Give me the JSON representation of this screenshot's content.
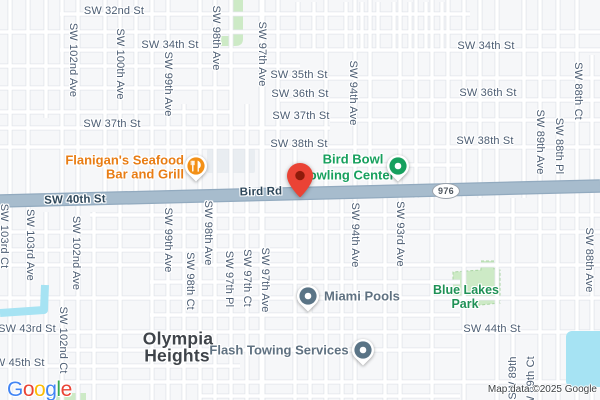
{
  "map": {
    "attribution": "Map data ©2025 Google",
    "logo": {
      "text": "Google",
      "letter_colors": [
        "#4285F4",
        "#EA4335",
        "#FBBC05",
        "#4285F4",
        "#34A853",
        "#EA4335"
      ]
    },
    "route_shield": {
      "text": "976",
      "x": 445,
      "y": 190
    },
    "destination_pin": {
      "x": 300,
      "y": 197
    },
    "colors": {
      "bg": "#f6f7f9",
      "road_fill": "#ffffff",
      "road_casing": "#e1e5ea",
      "major_fill": "#a7bccd",
      "major_casing": "#92aabf",
      "water": "#a6e3f3",
      "park": "#cdeac6",
      "park_edge": "#a9d4a2",
      "lot": "#e9edf1",
      "street_label": "#4c5d73",
      "onroad_label": "#2e475a",
      "poi_gray": "#5f7181",
      "poi_orange": "#e87d15",
      "icon_orange": "#f39016",
      "poi_green": "#17a05e",
      "icon_gray": "#5a7486",
      "park_label": "#1f9156",
      "neighborhood": "#3f444a",
      "pin": "#ea4335",
      "pin_inner": "#8e1b0b",
      "shield_border": "#9aa2ab",
      "shield_text": "#4e565e",
      "attribution": "#3c4043"
    },
    "street_labels": [
      {
        "t": "SW 32nd St",
        "x": 114,
        "y": 11
      },
      {
        "t": "SW 34th St",
        "x": 170,
        "y": 45
      },
      {
        "t": "SW 34th St",
        "x": 486,
        "y": 46
      },
      {
        "t": "SW 35th St",
        "x": 299,
        "y": 75
      },
      {
        "t": "SW 36th St",
        "x": 300,
        "y": 94
      },
      {
        "t": "SW 36th St",
        "x": 488,
        "y": 93
      },
      {
        "t": "SW 37th St",
        "x": 112,
        "y": 124
      },
      {
        "t": "SW 37th St",
        "x": 301,
        "y": 116
      },
      {
        "t": "SW 38th St",
        "x": 299,
        "y": 144
      },
      {
        "t": "SW 38th St",
        "x": 485,
        "y": 141
      },
      {
        "t": "SW 43rd St",
        "x": 27,
        "y": 329
      },
      {
        "t": "SW 44th St",
        "x": 492,
        "y": 329
      },
      {
        "t": "SW 45th St",
        "x": 16,
        "y": 363
      },
      {
        "t": "SW 40th St",
        "x": 75,
        "y": 200,
        "cls": "onroad",
        "name": "road-label-sw-40th-st"
      },
      {
        "t": "Bird Rd",
        "x": 261,
        "y": 192,
        "cls": "onroad",
        "name": "road-label-bird-rd"
      },
      {
        "t": "SW 102nd Ave",
        "x": 73,
        "y": 60,
        "cls": "v"
      },
      {
        "t": "SW 100th Ave",
        "x": 120,
        "y": 64,
        "cls": "v"
      },
      {
        "t": "SW 99th Ave",
        "x": 168,
        "y": 84,
        "cls": "v"
      },
      {
        "t": "SW 98th Ave",
        "x": 216,
        "y": 38,
        "cls": "v"
      },
      {
        "t": "SW 97th Ave",
        "x": 262,
        "y": 54,
        "cls": "v"
      },
      {
        "t": "SW 94th Ave",
        "x": 353,
        "y": 93,
        "cls": "v"
      },
      {
        "t": "SW 89th Ave",
        "x": 540,
        "y": 142,
        "cls": "v"
      },
      {
        "t": "SW 88th Pl",
        "x": 559,
        "y": 146,
        "cls": "v"
      },
      {
        "t": "SW 88th Ct",
        "x": 578,
        "y": 91,
        "cls": "v"
      },
      {
        "t": "SW 103rd Ct",
        "x": 4,
        "y": 236,
        "cls": "v"
      },
      {
        "t": "SW 103rd Ave",
        "x": 30,
        "y": 245,
        "cls": "v"
      },
      {
        "t": "SW 102nd Ave",
        "x": 76,
        "y": 253,
        "cls": "v"
      },
      {
        "t": "SW 99th Ave",
        "x": 168,
        "y": 240,
        "cls": "v"
      },
      {
        "t": "SW 98th Ave",
        "x": 208,
        "y": 233,
        "cls": "v"
      },
      {
        "t": "SW 98th Ct",
        "x": 190,
        "y": 281,
        "cls": "v"
      },
      {
        "t": "SW 97th Pl",
        "x": 229,
        "y": 279,
        "cls": "v"
      },
      {
        "t": "SW 97th Ct",
        "x": 247,
        "y": 278,
        "cls": "v"
      },
      {
        "t": "SW 97th Ave",
        "x": 265,
        "y": 280,
        "cls": "v"
      },
      {
        "t": "SW 94th Ave",
        "x": 355,
        "y": 235,
        "cls": "v"
      },
      {
        "t": "SW 93rd Ave",
        "x": 400,
        "y": 234,
        "cls": "v"
      },
      {
        "t": "SW 88th Ave",
        "x": 589,
        "y": 260,
        "cls": "v"
      },
      {
        "t": "SW 102nd Ct",
        "x": 63,
        "y": 340,
        "cls": "v"
      },
      {
        "t": "SW 89th",
        "x": 513,
        "y": 378,
        "cls": "vu"
      },
      {
        "t": "SW 89th Ct",
        "x": 531,
        "y": 385,
        "cls": "vu"
      }
    ],
    "pois": [
      {
        "id": "flanigans-seafood-bar-and-grill",
        "color": "#e87d15",
        "icon": {
          "type": "restaurant",
          "bg": "#f39016",
          "x": 196,
          "y": 166
        },
        "lines": [
          {
            "t": "Flanigan's Seafood",
            "x": 184,
            "y": 160,
            "anchor": "r"
          },
          {
            "t": "Bar and Grill",
            "x": 184,
            "y": 174,
            "anchor": "r"
          }
        ]
      },
      {
        "id": "bird-bowl-bowling-center",
        "color": "#17a05e",
        "icon": {
          "type": "dot",
          "bg": "#17a05e",
          "x": 398,
          "y": 166
        },
        "lines": [
          {
            "t": "Bird Bowl",
            "x": 353,
            "y": 159
          },
          {
            "t": "Bowling Center",
            "x": 347,
            "y": 175
          }
        ]
      },
      {
        "id": "miami-pools",
        "color": "#5f7181",
        "icon": {
          "type": "dot",
          "bg": "#5a7486",
          "x": 308,
          "y": 296
        },
        "lines": [
          {
            "t": "Miami Pools",
            "x": 324,
            "y": 296,
            "anchor": "l"
          }
        ]
      },
      {
        "id": "flash-towing-services",
        "color": "#5f7181",
        "icon": {
          "type": "dot",
          "bg": "#5a7486",
          "x": 363,
          "y": 350
        },
        "lines": [
          {
            "t": "Flash Towing Services",
            "x": 279,
            "y": 350
          }
        ]
      }
    ],
    "areas": [
      {
        "id": "olympia-heights",
        "cls": "neigh",
        "color": "#3f444a",
        "lines": [
          {
            "t": "Olympia",
            "x": 178,
            "y": 339
          },
          {
            "t": "Heights",
            "x": 177,
            "y": 356
          }
        ]
      },
      {
        "id": "blue-lakes-park",
        "cls": "park-lbl",
        "color": "#1f9156",
        "lines": [
          {
            "t": "Blue Lakes",
            "x": 466,
            "y": 290
          },
          {
            "t": "Park",
            "x": 465,
            "y": 304
          }
        ]
      }
    ],
    "geometry": {
      "major_road": {
        "x1": 0,
        "y1": 201,
        "x2": 600,
        "y2": 186
      },
      "vertical_roads": [
        {
          "x": 10,
          "y1": 0,
          "y2": 400
        },
        {
          "x": 28,
          "y1": 0,
          "y2": 400
        },
        {
          "x": 46,
          "y1": 0,
          "y2": 118
        },
        {
          "x": 46,
          "y1": 212,
          "y2": 400
        },
        {
          "x": 62,
          "y1": 0,
          "y2": 400
        },
        {
          "x": 78,
          "y1": 0,
          "y2": 400
        },
        {
          "x": 94,
          "y1": 212,
          "y2": 400
        },
        {
          "x": 105,
          "y1": 0,
          "y2": 197
        },
        {
          "x": 120,
          "y1": 0,
          "y2": 400
        },
        {
          "x": 136,
          "y1": 0,
          "y2": 197
        },
        {
          "x": 152,
          "y1": 0,
          "y2": 400
        },
        {
          "x": 168,
          "y1": 0,
          "y2": 400
        },
        {
          "x": 184,
          "y1": 104,
          "y2": 400
        },
        {
          "x": 200,
          "y1": 0,
          "y2": 400
        },
        {
          "x": 215,
          "y1": 0,
          "y2": 400
        },
        {
          "x": 231,
          "y1": 0,
          "y2": 400
        },
        {
          "x": 247,
          "y1": 104,
          "y2": 400
        },
        {
          "x": 262,
          "y1": 0,
          "y2": 400,
          "w": 1
        },
        {
          "x": 278,
          "y1": 0,
          "y2": 198
        },
        {
          "x": 295,
          "y1": 142,
          "y2": 400
        },
        {
          "x": 310,
          "y1": 198,
          "y2": 400
        },
        {
          "x": 326,
          "y1": 0,
          "y2": 400
        },
        {
          "x": 342,
          "y1": 198,
          "y2": 400
        },
        {
          "x": 355,
          "y1": 0,
          "y2": 400
        },
        {
          "x": 370,
          "y1": 0,
          "y2": 198
        },
        {
          "x": 385,
          "y1": 198,
          "y2": 400
        },
        {
          "x": 400,
          "y1": 0,
          "y2": 400
        },
        {
          "x": 416,
          "y1": 0,
          "y2": 198
        },
        {
          "x": 432,
          "y1": 0,
          "y2": 400
        },
        {
          "x": 448,
          "y1": 0,
          "y2": 198
        },
        {
          "x": 464,
          "y1": 0,
          "y2": 400
        },
        {
          "x": 480,
          "y1": 0,
          "y2": 198
        },
        {
          "x": 497,
          "y1": 0,
          "y2": 400
        },
        {
          "x": 513,
          "y1": 198,
          "y2": 400
        },
        {
          "x": 524,
          "y1": 0,
          "y2": 198
        },
        {
          "x": 540,
          "y1": 0,
          "y2": 400
        },
        {
          "x": 558,
          "y1": 0,
          "y2": 400
        },
        {
          "x": 577,
          "y1": 0,
          "y2": 400
        },
        {
          "x": 592,
          "y1": 55,
          "y2": 400
        },
        {
          "x": 298,
          "y1": 2,
          "y2": 50
        },
        {
          "x": 314,
          "y1": 2,
          "y2": 50
        },
        {
          "x": 346,
          "y1": 2,
          "y2": 50
        },
        {
          "x": 362,
          "y1": 2,
          "y2": 50
        },
        {
          "x": 378,
          "y1": 2,
          "y2": 50
        },
        {
          "x": 394,
          "y1": 2,
          "y2": 50
        },
        {
          "x": 410,
          "y1": 2,
          "y2": 50
        },
        {
          "x": 426,
          "y1": 2,
          "y2": 50
        },
        {
          "x": 442,
          "y1": 2,
          "y2": 50
        }
      ],
      "horizontal_roads": [
        {
          "y": 14,
          "x1": 60,
          "x2": 470
        },
        {
          "y": 32,
          "x1": 0,
          "x2": 600
        },
        {
          "y": 50,
          "x1": 60,
          "x2": 600
        },
        {
          "y": 66,
          "x1": 0,
          "x2": 300
        },
        {
          "y": 78,
          "x1": 280,
          "x2": 600
        },
        {
          "y": 88,
          "x1": 0,
          "x2": 230
        },
        {
          "y": 100,
          "x1": 280,
          "x2": 600
        },
        {
          "y": 112,
          "x1": 0,
          "x2": 230
        },
        {
          "y": 120,
          "x1": 330,
          "x2": 600
        },
        {
          "y": 128,
          "x1": 0,
          "x2": 330
        },
        {
          "y": 147,
          "x1": 0,
          "x2": 600
        },
        {
          "y": 165,
          "x1": 332,
          "x2": 462
        },
        {
          "y": 215,
          "x1": 90,
          "x2": 600
        },
        {
          "y": 232,
          "x1": 0,
          "x2": 600
        },
        {
          "y": 250,
          "x1": 0,
          "x2": 300
        },
        {
          "y": 265,
          "x1": 0,
          "x2": 600
        },
        {
          "y": 282,
          "x1": 150,
          "x2": 460
        },
        {
          "y": 298,
          "x1": 0,
          "x2": 600
        },
        {
          "y": 315,
          "x1": 150,
          "x2": 460
        },
        {
          "y": 332,
          "x1": 0,
          "x2": 600
        },
        {
          "y": 350,
          "x1": 60,
          "x2": 460
        },
        {
          "y": 366,
          "x1": 0,
          "x2": 240
        },
        {
          "y": 382,
          "x1": 60,
          "x2": 600
        },
        {
          "y": 396,
          "x1": 200,
          "x2": 460
        }
      ],
      "parks": [
        {
          "d": "M229 0 H243 V39 Q243 46 235 46 H221 V36 H229 Z"
        },
        {
          "d": "M481 261 L494 261 L494 269 L500 270 L500 303 L471 306 L453 302 L453 272 L481 270 Z",
          "dashed": true
        },
        {
          "d": "M46 393 H86 V400 H46 Z"
        }
      ],
      "water": [
        {
          "type": "rect",
          "x": 566,
          "y": 331,
          "w": 40,
          "h": 56,
          "rx": 6
        },
        {
          "type": "stroke",
          "d": "M0 313 L44 310 L45 285",
          "sw": 8
        }
      ],
      "lots": [
        {
          "x": 207,
          "y": 149,
          "w": 48,
          "h": 24
        }
      ]
    }
  }
}
